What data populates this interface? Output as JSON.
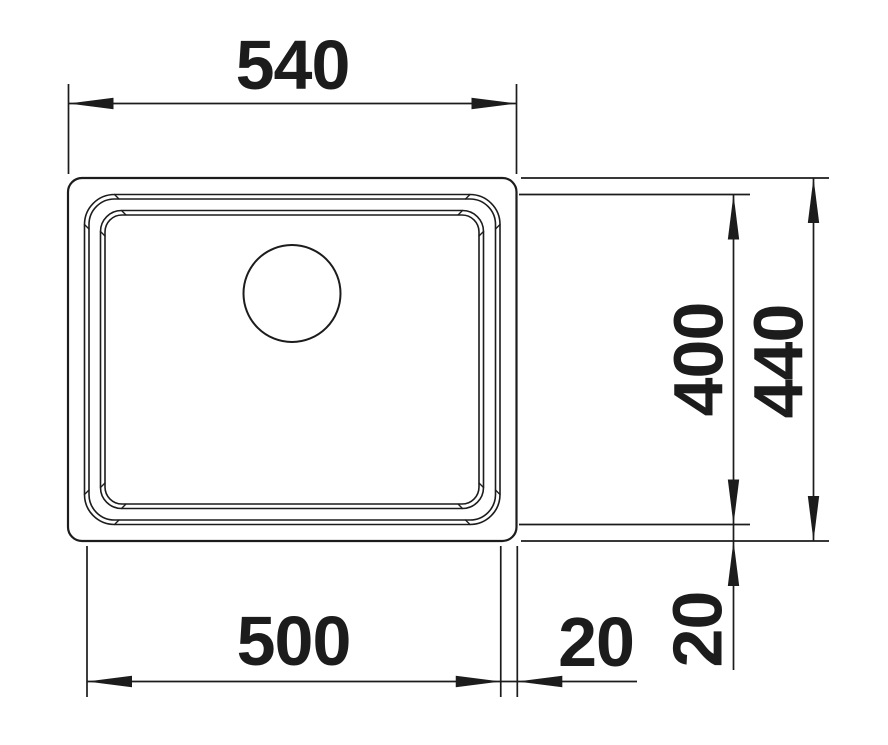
{
  "drawing": {
    "kind": "technical-dimension-drawing",
    "subject": "sink-top-view",
    "line_color": "#1c1c1c",
    "background_color": "#ffffff",
    "labels": {
      "width_outer": "540",
      "width_bowl": "500",
      "offset_right": "20",
      "height_bowl": "400",
      "height_outer": "440",
      "offset_bottom": "20"
    }
  }
}
